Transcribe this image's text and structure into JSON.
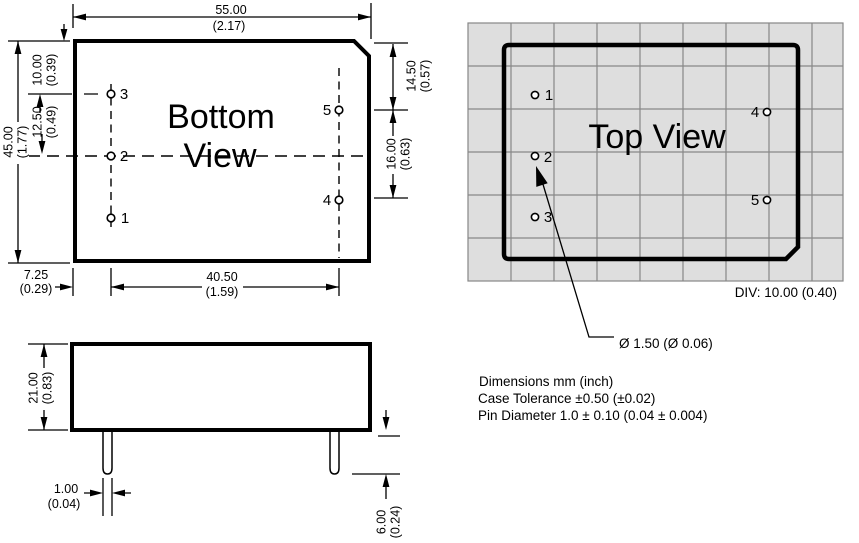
{
  "colors": {
    "ink": "#000000",
    "grid_bg": "#dedede",
    "grid_line": "#878787"
  },
  "bottom_view": {
    "title_line1": "Bottom",
    "title_line2": "View",
    "pin_labels": {
      "p1": "1",
      "p2": "2",
      "p3": "3",
      "p4": "4",
      "p5": "5"
    },
    "dims": {
      "width_mm": "55.00",
      "width_in": "(2.17)",
      "height_mm": "45.00",
      "height_in": "(1.77)",
      "top_to_pin3_mm": "10.00",
      "top_to_pin3_in": "(0.39)",
      "pin3_to_pin2_mm": "12.50",
      "pin3_to_pin2_in": "(0.49)",
      "top_to_pin5_mm": "14.50",
      "top_to_pin5_in": "(0.57)",
      "pin5_to_pin4_mm": "16.00",
      "pin5_to_pin4_in": "(0.63)",
      "edge_to_pin_col_mm": "7.25",
      "edge_to_pin_col_in": "(0.29)",
      "pin_col_span_mm": "40.50",
      "pin_col_span_in": "(1.59)"
    }
  },
  "side_view": {
    "dims": {
      "height_mm": "21.00",
      "height_in": "(0.83)",
      "pin_dia_mm": "1.00",
      "pin_dia_in": "(0.04)",
      "pin_len_mm": "6.00",
      "pin_len_in": "(0.24)"
    }
  },
  "top_view": {
    "title": "Top View",
    "pin_labels": {
      "p1": "1",
      "p2": "2",
      "p3": "3",
      "p4": "4",
      "p5": "5"
    },
    "div_note": "DIV: 10.00 (0.40)",
    "pin_dia_callout": "Ø 1.50 (Ø 0.06)"
  },
  "notes": {
    "line1": "Dimensions mm (inch)",
    "line2": "Case Tolerance ±0.50 (±0.02)",
    "line3": "Pin Diameter 1.0 ± 0.10 (0.04 ± 0.004)"
  }
}
